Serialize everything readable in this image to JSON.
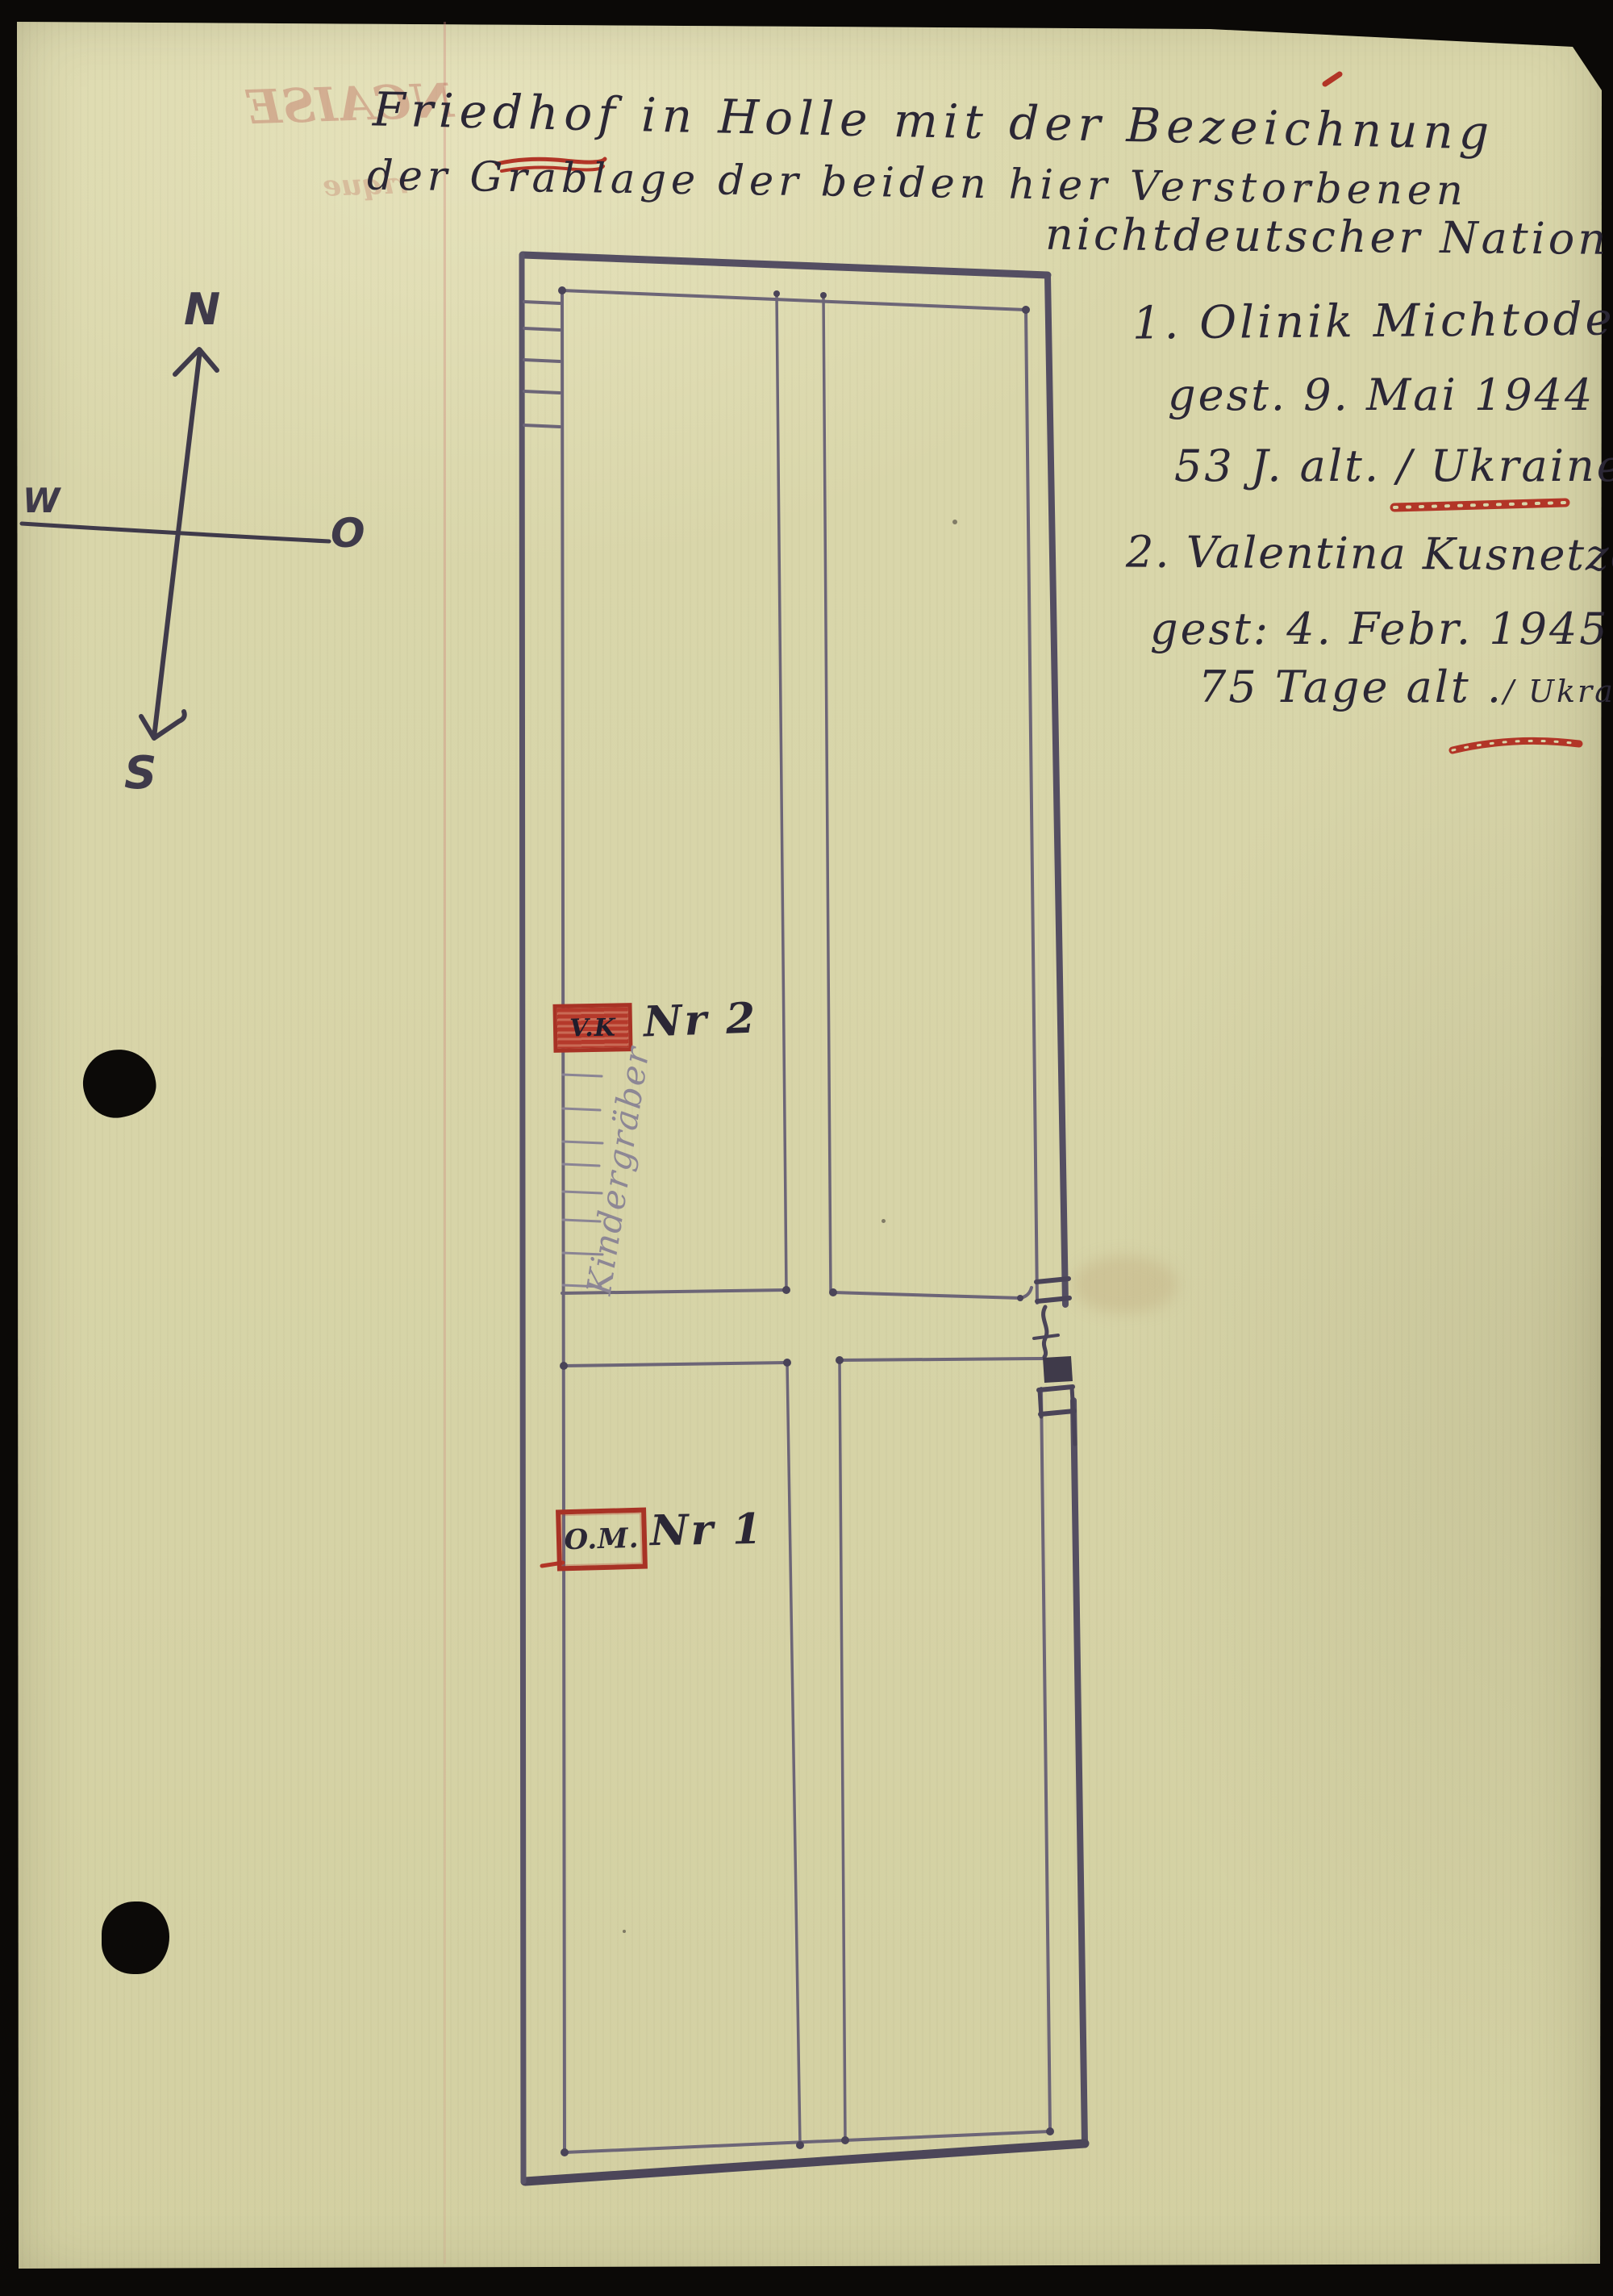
{
  "title": {
    "line1": "Friedhof in Holle mit der Bezeichnung",
    "line2": "der Grablage der beiden hier Verstorbenen",
    "line3": "nichtdeutscher Nation :",
    "underlined_word": "Holle"
  },
  "deceased": [
    {
      "line1": "1. Olinik Michtode",
      "line2": "gest. 9. Mai 1944",
      "line3": "53 J. alt. / Ukraine"
    },
    {
      "line1": "2. Valentina Kusnetzowa",
      "line2": "gest: 4. Febr. 1945",
      "line3": "75 Tage alt .",
      "line3_suffix": "/ Ukraine"
    }
  ],
  "plan": {
    "children_graves_label": "Kindergräber",
    "markers": [
      {
        "initials": "V.K",
        "number": "Nr 2"
      },
      {
        "initials": "O.M.",
        "number": "Nr 1"
      }
    ]
  },
  "compass": {
    "n": "N",
    "w": "W",
    "e": "O",
    "s": "S"
  },
  "bleed": {
    "line1": "NCAISE",
    "line2": "rique"
  },
  "colors": {
    "paper": "#d8d5a9",
    "ink": "#2b2735",
    "pencil": "#6c6577",
    "red": "#b23527"
  }
}
